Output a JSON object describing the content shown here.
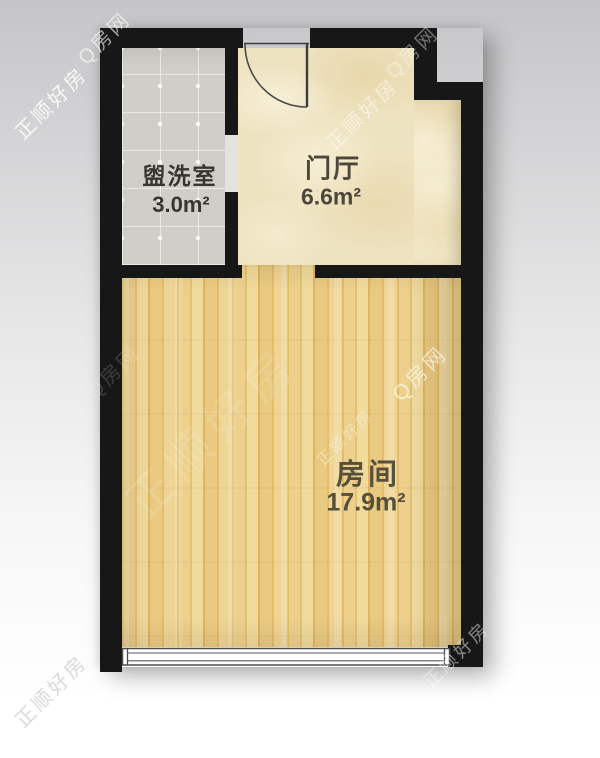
{
  "rooms": [
    {
      "name": "盥洗室",
      "area": "3.0m²"
    },
    {
      "name": "门厅",
      "area": "6.6m²"
    },
    {
      "name": "房间",
      "area": "17.9m²"
    }
  ],
  "watermark": {
    "brand": "正顺好房",
    "site": "Q房网"
  },
  "colors": {
    "wall": "#171717",
    "washroom_tile": "#cfcec9",
    "hall_floor": "#eee3c1",
    "wood_floor": "#e8c77d",
    "label_text": "#4c473a"
  }
}
